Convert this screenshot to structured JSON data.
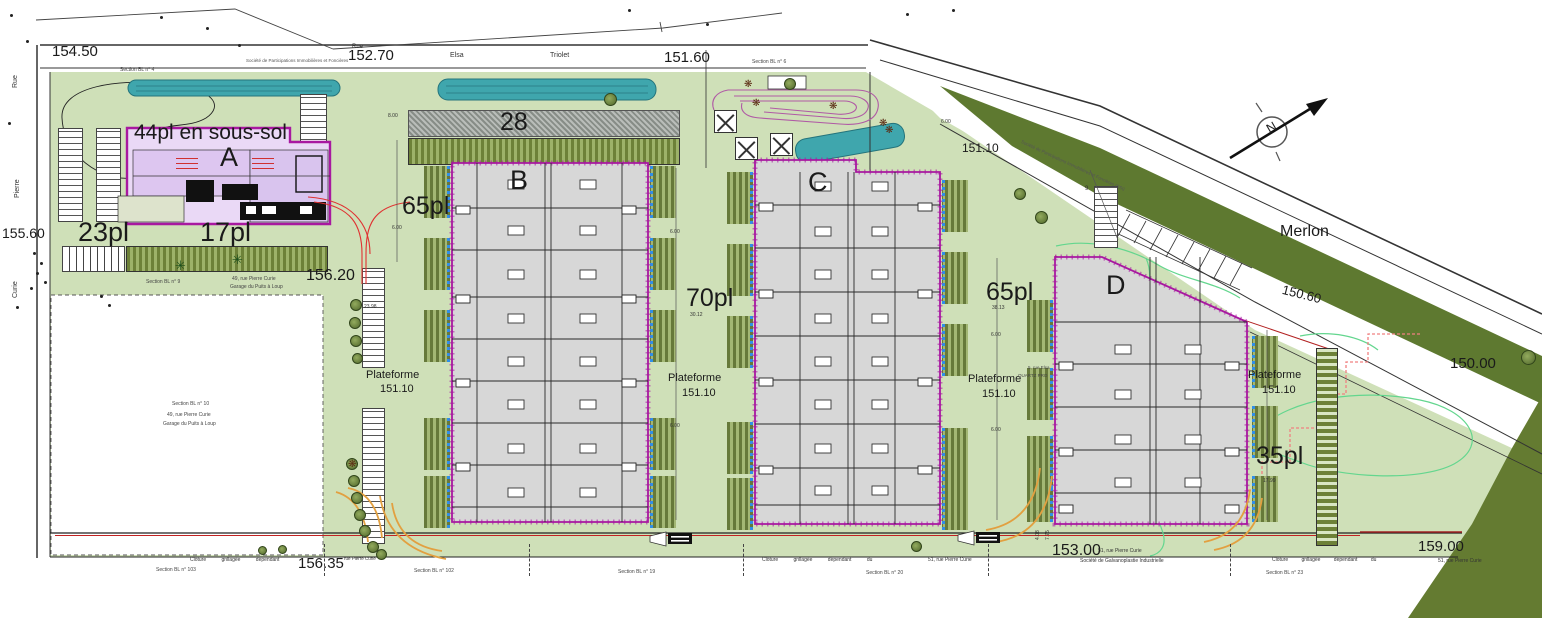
{
  "palette": {
    "site_green": "#cfe0b8",
    "merlon_green": "#5e7930",
    "wedge_green": "#647b31",
    "water": "#3fa6ad",
    "building_fill": "#d7d7d7",
    "building_outline": "#a818a0",
    "building_a_fill": "#ead9f6",
    "accent_red": "#d03030",
    "orange_curb": "#e2a040",
    "contour_green": "#63d68e",
    "dashed_red": "#f08080",
    "dock_blue": "#2f8fe8"
  },
  "labels": [
    {
      "n": "elevation-154-50",
      "t": "154.50",
      "x": 52,
      "y": 44,
      "s": 15
    },
    {
      "n": "elevation-152-70",
      "t": "152.70",
      "x": 348,
      "y": 48,
      "s": 15
    },
    {
      "n": "elevation-151-60",
      "t": "151.60",
      "x": 664,
      "y": 50,
      "s": 15
    },
    {
      "n": "elevation-151-10",
      "t": "151.10",
      "x": 962,
      "y": 142,
      "s": 12
    },
    {
      "n": "elevation-155-60",
      "t": "155.60",
      "x": 2,
      "y": 226,
      "s": 14
    },
    {
      "n": "elevation-156-20",
      "t": "156.20",
      "x": 306,
      "y": 268,
      "s": 16
    },
    {
      "n": "elevation-150-60",
      "t": "150.60",
      "x": 1284,
      "y": 283,
      "s": 13,
      "r": 14
    },
    {
      "n": "elevation-150-00",
      "t": "150.00",
      "x": 1450,
      "y": 356,
      "s": 15
    },
    {
      "n": "elevation-156-35",
      "t": "156.35",
      "x": 298,
      "y": 556,
      "s": 15
    },
    {
      "n": "elevation-153-00",
      "t": "153.00",
      "x": 1052,
      "y": 543,
      "s": 16
    },
    {
      "n": "elevation-159-00",
      "t": "159.00",
      "x": 1418,
      "y": 539,
      "s": 15
    },
    {
      "n": "parking-44pl-sous-sol",
      "t": "44pl en sous-sol",
      "x": 134,
      "y": 122,
      "s": 21
    },
    {
      "n": "building-a-label",
      "t": "A",
      "x": 220,
      "y": 144,
      "s": 27
    },
    {
      "n": "parking-23pl",
      "t": "23pl",
      "x": 78,
      "y": 219,
      "s": 27
    },
    {
      "n": "parking-17pl",
      "t": "17pl",
      "x": 200,
      "y": 219,
      "s": 27
    },
    {
      "n": "parking-65pl-west",
      "t": "65pl",
      "x": 402,
      "y": 194,
      "s": 25
    },
    {
      "n": "parking-28",
      "t": "28",
      "x": 500,
      "y": 110,
      "s": 25
    },
    {
      "n": "building-b-label",
      "t": "B",
      "x": 510,
      "y": 167,
      "s": 27
    },
    {
      "n": "parking-70pl",
      "t": "70pl",
      "x": 686,
      "y": 286,
      "s": 25
    },
    {
      "n": "building-c-label",
      "t": "C",
      "x": 808,
      "y": 169,
      "s": 27
    },
    {
      "n": "parking-65pl-east",
      "t": "65pl",
      "x": 986,
      "y": 280,
      "s": 25
    },
    {
      "n": "building-d-label",
      "t": "D",
      "x": 1106,
      "y": 272,
      "s": 27
    },
    {
      "n": "parking-35pl",
      "t": "35pl",
      "x": 1256,
      "y": 444,
      "s": 25
    },
    {
      "n": "merlon-label",
      "t": "Merlon",
      "x": 1280,
      "y": 224,
      "s": 16
    },
    {
      "n": "plateforme-1-line1",
      "t": "Plateforme",
      "x": 366,
      "y": 370,
      "s": 11
    },
    {
      "n": "plateforme-1-line2",
      "t": "151.10",
      "x": 380,
      "y": 384,
      "s": 11
    },
    {
      "n": "plateforme-2-line1",
      "t": "Plateforme",
      "x": 668,
      "y": 373,
      "s": 11
    },
    {
      "n": "plateforme-2-line2",
      "t": "151.10",
      "x": 682,
      "y": 388,
      "s": 11
    },
    {
      "n": "plateforme-3-line1",
      "t": "Plateforme",
      "x": 968,
      "y": 374,
      "s": 11
    },
    {
      "n": "plateforme-3-line2",
      "t": "151.10",
      "x": 982,
      "y": 389,
      "s": 11
    },
    {
      "n": "plateforme-4-line1",
      "t": "Plateforme",
      "x": 1248,
      "y": 370,
      "s": 11
    },
    {
      "n": "plateforme-4-line2",
      "t": "151.10",
      "x": 1262,
      "y": 385,
      "s": 11
    },
    {
      "n": "street-elsa",
      "t": "Elsa",
      "x": 450,
      "y": 52,
      "s": 7,
      "c": "#333"
    },
    {
      "n": "street-triolet",
      "t": "Triolet",
      "x": 550,
      "y": 52,
      "s": 7,
      "c": "#333"
    },
    {
      "n": "street-rue-top",
      "t": "Rue",
      "x": 352,
      "y": 44,
      "s": 6,
      "c": "#333"
    },
    {
      "n": "street-rue",
      "t": "Rue",
      "x": 12,
      "y": 88,
      "s": 7,
      "r": -90,
      "c": "#333"
    },
    {
      "n": "street-pierre",
      "t": "Pierre",
      "x": 14,
      "y": 198,
      "s": 7,
      "r": -90,
      "c": "#333"
    },
    {
      "n": "street-curie",
      "t": "Curie",
      "x": 12,
      "y": 298,
      "s": 7,
      "r": -90,
      "c": "#333"
    },
    {
      "n": "section-bl-4",
      "t": "Section BL n° 4",
      "x": 120,
      "y": 68,
      "s": 5,
      "c": "#444"
    },
    {
      "n": "section-bl-6",
      "t": "Section BL n° 6",
      "x": 752,
      "y": 60,
      "s": 5,
      "c": "#444"
    },
    {
      "n": "section-bl-9",
      "t": "Section BL n° 9",
      "x": 146,
      "y": 280,
      "s": 5,
      "c": "#444"
    },
    {
      "n": "parcel-section-bl-10",
      "t": "Section BL n° 10",
      "x": 172,
      "y": 402,
      "s": 5,
      "c": "#444"
    },
    {
      "n": "parcel-address-49",
      "t": "49, rue Pierre Curie",
      "x": 167,
      "y": 413,
      "s": 5,
      "c": "#444"
    },
    {
      "n": "parcel-garage",
      "t": "Garage du Puits à Loup",
      "x": 163,
      "y": 422,
      "s": 5,
      "c": "#444"
    },
    {
      "n": "address-49-top",
      "t": "49, rue Pierre Curie",
      "x": 232,
      "y": 277,
      "s": 5,
      "c": "#444"
    },
    {
      "n": "garage-top",
      "t": "Garage du Puits à Loup",
      "x": 230,
      "y": 285,
      "s": 5,
      "c": "#444"
    },
    {
      "n": "section-bl-103",
      "t": "Section BL n° 103",
      "x": 156,
      "y": 568,
      "s": 5,
      "c": "#444"
    },
    {
      "n": "section-bl-102",
      "t": "Section BL n° 102",
      "x": 414,
      "y": 569,
      "s": 5,
      "c": "#444"
    },
    {
      "n": "section-bl-19",
      "t": "Section BL n° 19",
      "x": 618,
      "y": 570,
      "s": 5,
      "c": "#444"
    },
    {
      "n": "section-bl-20",
      "t": "Section BL n° 20",
      "x": 866,
      "y": 571,
      "s": 5,
      "c": "#444"
    },
    {
      "n": "section-bl-23",
      "t": "Section BL n° 23",
      "x": 1266,
      "y": 571,
      "s": 5,
      "c": "#444"
    },
    {
      "n": "cloture-left",
      "t": "Clôture grillagée dépendant",
      "x": 190,
      "y": 558,
      "s": 5,
      "ws": 14,
      "c": "#333"
    },
    {
      "n": "cloture-mid",
      "t": "Clôture grillagée dépendant du",
      "x": 762,
      "y": 558,
      "s": 5,
      "ws": 14,
      "c": "#333"
    },
    {
      "n": "address-51-mid",
      "t": "51, rue Pierre Curie",
      "x": 928,
      "y": 558,
      "s": 5,
      "c": "#333"
    },
    {
      "n": "cloture-right",
      "t": "Clôture grillagée dépendant du",
      "x": 1272,
      "y": 558,
      "s": 5,
      "ws": 12,
      "c": "#333"
    },
    {
      "n": "address-51-right",
      "t": "51, rue Pierre Curie",
      "x": 1438,
      "y": 559,
      "s": 5,
      "c": "#333"
    },
    {
      "n": "address-156-35",
      "t": "rue Pierre Curie",
      "x": 344,
      "y": 557,
      "s": 4.5,
      "c": "#333"
    },
    {
      "n": "address-51-15300",
      "t": "51, rue Pierre Curie",
      "x": 1098,
      "y": 549,
      "s": 5,
      "c": "#333"
    },
    {
      "n": "societe-galvanoplastie",
      "t": "Société de Galvanoplastie Industrielle",
      "x": 1080,
      "y": 559,
      "s": 5,
      "c": "#333"
    },
    {
      "n": "societe-participations-top",
      "t": "Société de Participations Immobilières et Foncières",
      "x": 246,
      "y": 59,
      "s": 4.5,
      "c": "#555"
    },
    {
      "n": "societe-participations-diag",
      "t": "Société de Participations Immobilières et Foncières (SSI)",
      "x": 1022,
      "y": 140,
      "s": 4.5,
      "r": 25,
      "c": "#555"
    },
    {
      "n": "address-5-rue-elsa",
      "t": "5, rue Elsa",
      "x": 1028,
      "y": 366,
      "s": 4.5,
      "c": "#444"
    },
    {
      "n": "quartz-pro",
      "t": "QUARTZ PRO",
      "x": 1018,
      "y": 374,
      "s": 4.5,
      "c": "#444"
    },
    {
      "n": "dim-6-00-a",
      "t": "6.00",
      "x": 670,
      "y": 230,
      "s": 5,
      "c": "#333"
    },
    {
      "n": "dim-6-00-b",
      "t": "6.00",
      "x": 670,
      "y": 424,
      "s": 5,
      "c": "#333"
    },
    {
      "n": "dim-6-00-c",
      "t": "6.00",
      "x": 991,
      "y": 333,
      "s": 5,
      "c": "#333"
    },
    {
      "n": "dim-6-00-d",
      "t": "6.00",
      "x": 991,
      "y": 428,
      "s": 5,
      "c": "#333"
    },
    {
      "n": "dim-6-00-e",
      "t": "6.00",
      "x": 392,
      "y": 226,
      "s": 5,
      "c": "#333"
    },
    {
      "n": "dim-6-00-f",
      "t": "6.00",
      "x": 941,
      "y": 120,
      "s": 5,
      "c": "#333"
    },
    {
      "n": "dim-8-00",
      "t": "8.00",
      "x": 388,
      "y": 114,
      "s": 5,
      "c": "#333"
    },
    {
      "n": "dim-23-98",
      "t": "23.98",
      "x": 364,
      "y": 305,
      "s": 5,
      "c": "#333"
    },
    {
      "n": "dim-30-12",
      "t": "30.12",
      "x": 690,
      "y": 313,
      "s": 5,
      "c": "#333"
    },
    {
      "n": "dim-38-13",
      "t": "38.13",
      "x": 992,
      "y": 306,
      "s": 5,
      "c": "#333"
    },
    {
      "n": "dim-17-99",
      "t": "17.99",
      "x": 1263,
      "y": 479,
      "s": 5,
      "c": "#333"
    },
    {
      "n": "dim-4-08",
      "t": "4.08",
      "x": 1036,
      "y": 540,
      "s": 5,
      "r": -90,
      "c": "#333"
    },
    {
      "n": "dim-7-75",
      "t": "7.75",
      "x": 1046,
      "y": 540,
      "s": 5,
      "r": -90,
      "c": "#333"
    },
    {
      "n": "dim-9",
      "t": "9",
      "x": 1085,
      "y": 186,
      "s": 6,
      "c": "#333"
    },
    {
      "n": "compass-north",
      "t": "N",
      "x": 1264,
      "y": 124,
      "s": 13,
      "r": -30,
      "c": "#222"
    }
  ],
  "trees": [
    {
      "x": 350,
      "y": 299,
      "d": 12
    },
    {
      "x": 349,
      "y": 317,
      "d": 12
    },
    {
      "x": 350,
      "y": 335,
      "d": 12
    },
    {
      "x": 352,
      "y": 353,
      "d": 11
    },
    {
      "x": 346,
      "y": 458,
      "d": 12
    },
    {
      "x": 348,
      "y": 475,
      "d": 12
    },
    {
      "x": 351,
      "y": 492,
      "d": 12
    },
    {
      "x": 354,
      "y": 509,
      "d": 12
    },
    {
      "x": 359,
      "y": 525,
      "d": 12
    },
    {
      "x": 367,
      "y": 541,
      "d": 12
    },
    {
      "x": 376,
      "y": 549,
      "d": 11
    },
    {
      "x": 604,
      "y": 93,
      "d": 13
    },
    {
      "x": 784,
      "y": 78,
      "d": 12
    },
    {
      "x": 1014,
      "y": 188,
      "d": 12
    },
    {
      "x": 1035,
      "y": 211,
      "d": 13
    },
    {
      "x": 911,
      "y": 541,
      "d": 11
    },
    {
      "x": 1521,
      "y": 350,
      "d": 15
    },
    {
      "x": 258,
      "y": 546,
      "d": 9
    },
    {
      "x": 278,
      "y": 545,
      "d": 9
    }
  ],
  "flowers": [
    {
      "x": 744,
      "y": 80
    },
    {
      "x": 752,
      "y": 99
    },
    {
      "x": 829,
      "y": 102
    },
    {
      "x": 879,
      "y": 119
    },
    {
      "x": 885,
      "y": 126
    },
    {
      "x": 348,
      "y": 460
    }
  ],
  "palms": [
    {
      "x": 232,
      "y": 254
    },
    {
      "x": 175,
      "y": 260
    }
  ],
  "glyphs": {
    "flower": "❋",
    "palm": "✳"
  },
  "xboxes": [
    {
      "x": 714,
      "y": 110,
      "s": 21
    },
    {
      "x": 735,
      "y": 137,
      "s": 21
    },
    {
      "x": 770,
      "y": 133,
      "s": 21
    }
  ],
  "strips": [
    {
      "x": 408,
      "y": 110,
      "w": 272,
      "h": 27,
      "cls": "hatch"
    },
    {
      "x": 408,
      "y": 138,
      "w": 272,
      "h": 27,
      "cls": "sg"
    },
    {
      "x": 126,
      "y": 246,
      "w": 202,
      "h": 26,
      "cls": "sg"
    },
    {
      "x": 62,
      "y": 246,
      "w": 63,
      "h": 26,
      "cls": "sv"
    },
    {
      "x": 58,
      "y": 128,
      "w": 25,
      "h": 94,
      "cls": "sw"
    },
    {
      "x": 96,
      "y": 128,
      "w": 25,
      "h": 94,
      "cls": "sw"
    },
    {
      "x": 300,
      "y": 94,
      "w": 27,
      "h": 112,
      "cls": "sw"
    },
    {
      "x": 362,
      "y": 268,
      "w": 23,
      "h": 100,
      "cls": "sw"
    },
    {
      "x": 362,
      "y": 408,
      "w": 23,
      "h": 136,
      "cls": "sw"
    },
    {
      "x": 1316,
      "y": 348,
      "w": 22,
      "h": 198,
      "cls": "sh"
    },
    {
      "x": 1094,
      "y": 186,
      "w": 24,
      "h": 62,
      "cls": "sw"
    }
  ],
  "docks": [
    {
      "x": 424,
      "y": 166,
      "side": "L"
    },
    {
      "x": 424,
      "y": 238,
      "side": "L"
    },
    {
      "x": 424,
      "y": 310,
      "side": "L"
    },
    {
      "x": 424,
      "y": 418,
      "side": "L"
    },
    {
      "x": 424,
      "y": 476,
      "side": "L"
    },
    {
      "x": 650,
      "y": 166,
      "side": "R"
    },
    {
      "x": 650,
      "y": 238,
      "side": "R"
    },
    {
      "x": 650,
      "y": 310,
      "side": "R"
    },
    {
      "x": 650,
      "y": 418,
      "side": "R"
    },
    {
      "x": 650,
      "y": 476,
      "side": "R"
    },
    {
      "x": 727,
      "y": 172,
      "side": "L"
    },
    {
      "x": 727,
      "y": 244,
      "side": "L"
    },
    {
      "x": 727,
      "y": 316,
      "side": "L"
    },
    {
      "x": 727,
      "y": 422,
      "side": "L"
    },
    {
      "x": 727,
      "y": 478,
      "side": "L"
    },
    {
      "x": 942,
      "y": 180,
      "side": "R"
    },
    {
      "x": 942,
      "y": 252,
      "side": "R"
    },
    {
      "x": 942,
      "y": 324,
      "side": "R"
    },
    {
      "x": 942,
      "y": 428,
      "side": "R"
    },
    {
      "x": 942,
      "y": 478,
      "side": "R"
    },
    {
      "x": 1027,
      "y": 300,
      "side": "L"
    },
    {
      "x": 1027,
      "y": 368,
      "side": "L"
    },
    {
      "x": 1027,
      "y": 436,
      "side": "L"
    },
    {
      "x": 1027,
      "y": 488,
      "side": "L",
      "h": 34
    },
    {
      "x": 1252,
      "y": 336,
      "side": "R"
    },
    {
      "x": 1252,
      "y": 406,
      "side": "R"
    },
    {
      "x": 1252,
      "y": 476,
      "side": "R",
      "h": 46
    }
  ],
  "dots": [
    [
      10,
      14
    ],
    [
      26,
      40
    ],
    [
      160,
      16
    ],
    [
      206,
      27
    ],
    [
      238,
      44
    ],
    [
      628,
      9
    ],
    [
      706,
      23
    ],
    [
      906,
      13
    ],
    [
      952,
      9
    ],
    [
      33,
      252
    ],
    [
      40,
      262
    ],
    [
      36,
      272
    ],
    [
      44,
      281
    ],
    [
      30,
      287
    ],
    [
      100,
      295
    ],
    [
      108,
      304
    ],
    [
      8,
      122
    ],
    [
      16,
      306
    ]
  ],
  "vseps": [
    324,
    529,
    743,
    988,
    1230
  ],
  "red_dashes": [
    [
      176,
      158
    ],
    [
      176,
      163
    ],
    [
      176,
      168
    ],
    [
      252,
      158
    ],
    [
      252,
      163
    ],
    [
      252,
      168
    ]
  ]
}
